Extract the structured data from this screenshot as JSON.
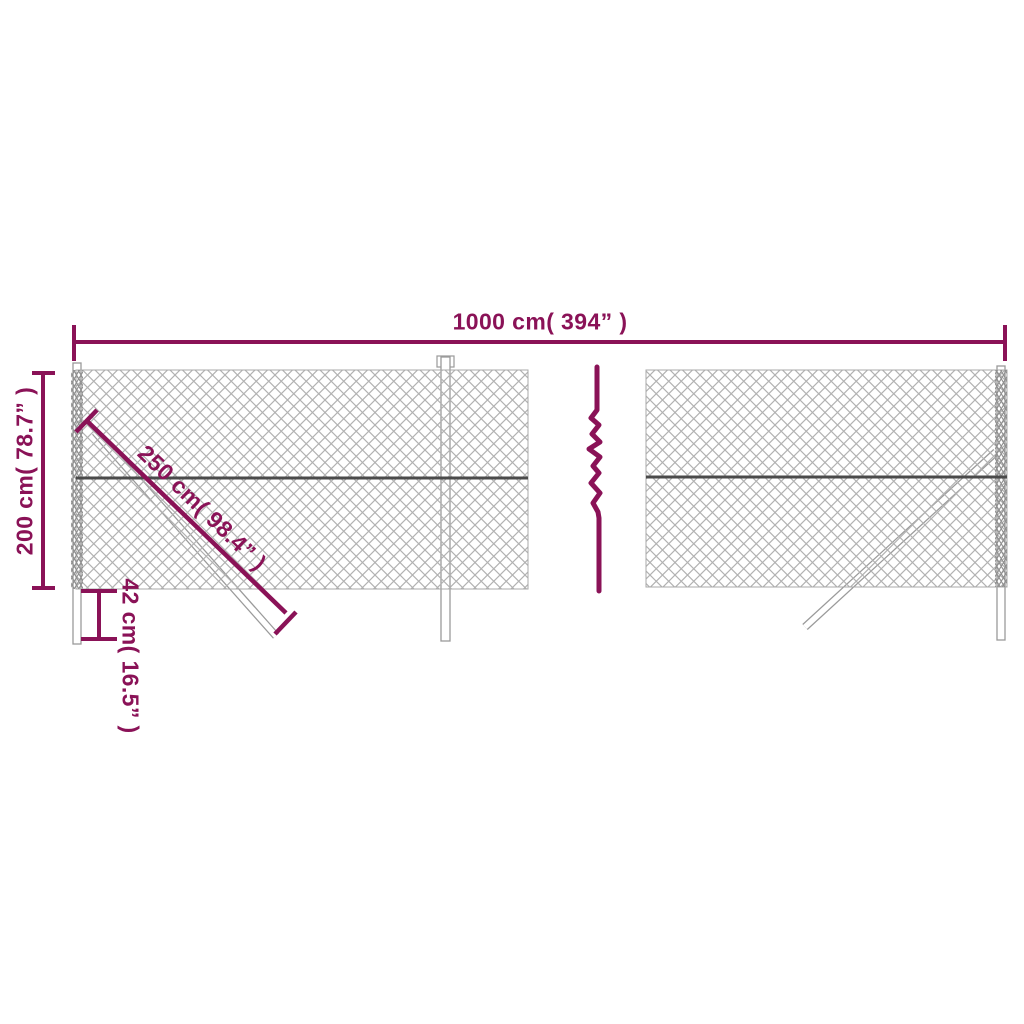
{
  "diagram": {
    "type": "product-dimension-diagram",
    "subject": "chain-link-fence",
    "labels": {
      "width": "1000 cm( 394” )",
      "height": "200 cm( 78.7” )",
      "brace_length": "250 cm( 98.4” )",
      "post_depth": "42 cm( 16.5” )"
    },
    "values": {
      "width_cm": 1000,
      "width_in": 394,
      "height_cm": 200,
      "height_in": 78.7,
      "brace_cm": 250,
      "brace_in": 98.4,
      "post_depth_cm": 42,
      "post_depth_in": 16.5
    },
    "icons": {
      "break_symbol": "zigzag-break-icon"
    },
    "colors": {
      "accent": "#8a1257",
      "mesh": "#b2b2b2",
      "mesh_dense_edge": "#8f8f8f",
      "rail": "#4a4a4a",
      "post_outline": "#9a9a9a",
      "post_fill": "#ffffff",
      "background": "#ffffff"
    }
  }
}
